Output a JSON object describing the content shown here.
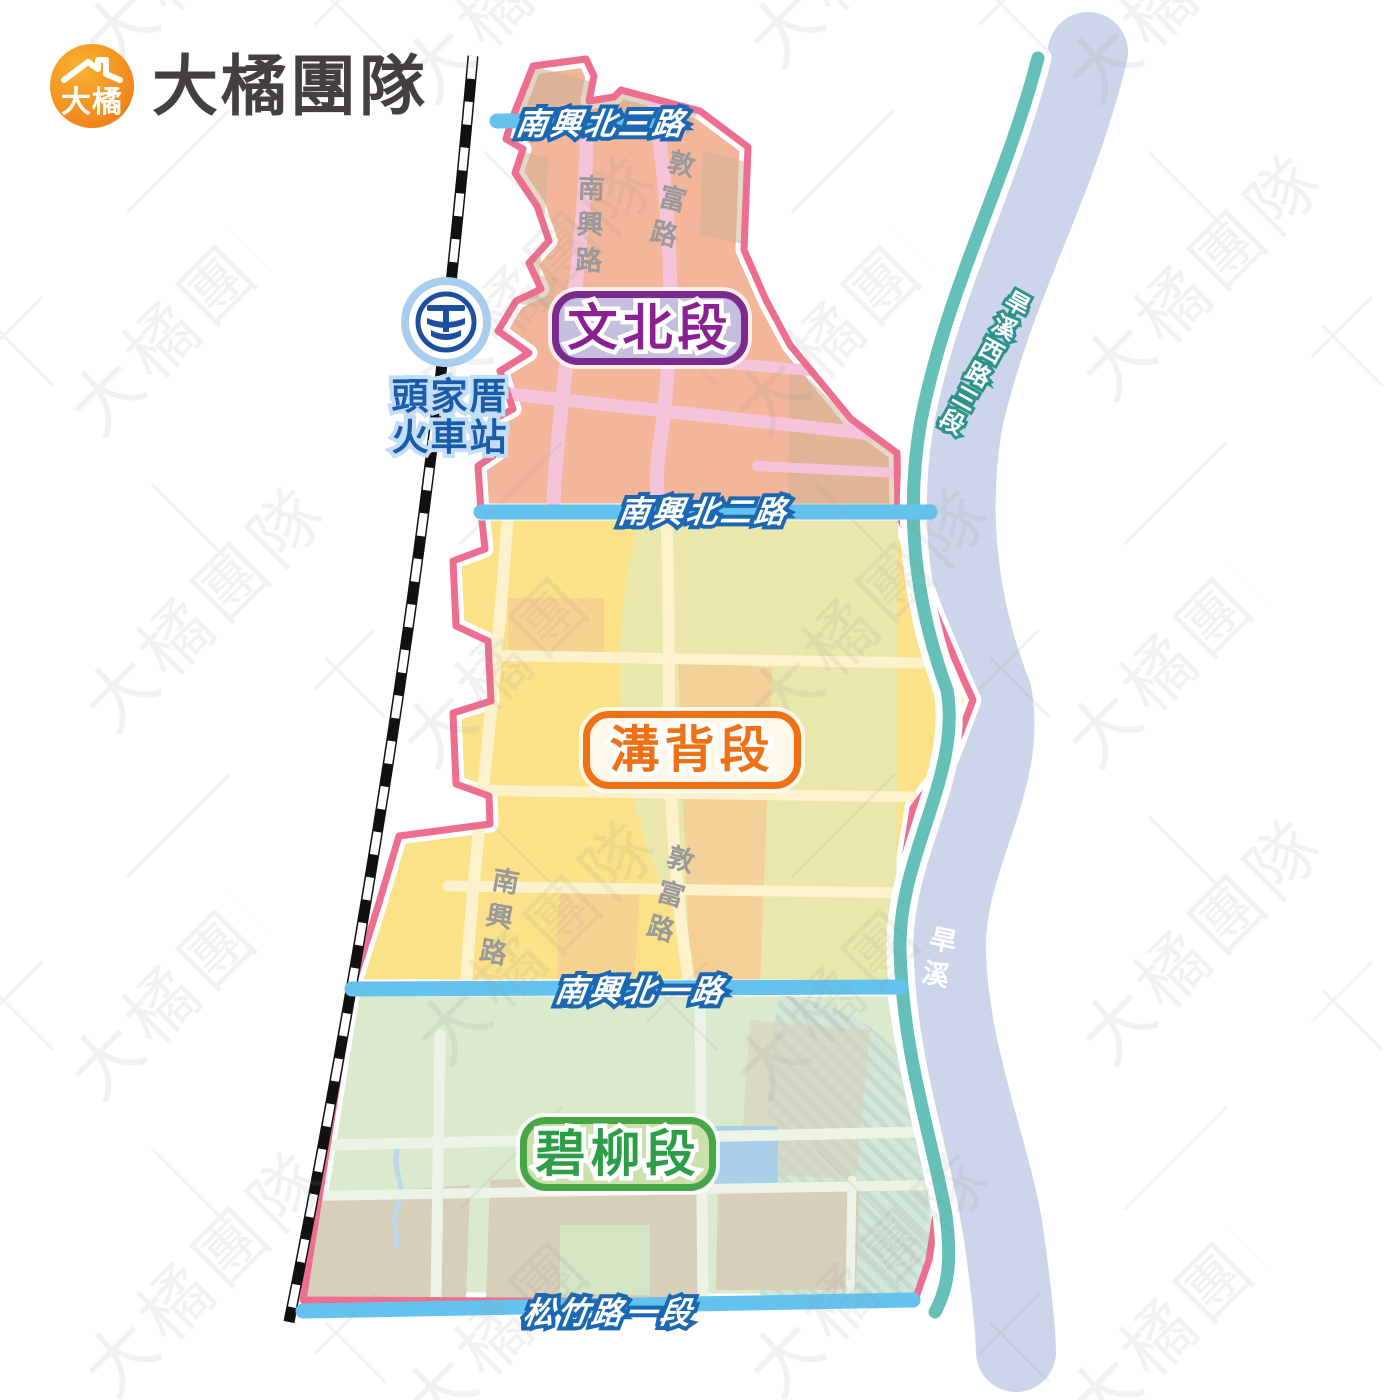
{
  "brand": {
    "badge_text": "大橘",
    "team_name": "大橘團隊"
  },
  "watermark": {
    "text": "大橘團隊"
  },
  "station": {
    "icon": "taiwan-railway-emblem",
    "name_line1": "頭家厝",
    "name_line2": "火車站"
  },
  "sections": [
    {
      "id": "wenbei",
      "label": "文北段",
      "box_fill": "#c6bedd",
      "box_border": "#7b2b8c",
      "text_color": "#8a2092",
      "area_fill": "#f4b69b"
    },
    {
      "id": "goubei",
      "label": "溝背段",
      "box_fill": "#fdf8ea",
      "box_border": "#ee7115",
      "text_color": "#ee7115",
      "area_fill": "#fbe289"
    },
    {
      "id": "biliu",
      "label": "碧柳段",
      "box_fill": "#cbe0ab",
      "box_border": "#47a648",
      "text_color": "#2d9e48",
      "area_fill": "#dbe9cd"
    }
  ],
  "roads": {
    "nanxing_north_3": "南興北三路",
    "nanxing_north_2": "南興北二路",
    "nanxing_north_1": "南興北一路",
    "songzhu_sec1": "松竹路一段",
    "hanxi_west_sec3": "旱溪西路三段"
  },
  "streets": {
    "nanxing": "南興路",
    "dunfu": "敦富路"
  },
  "river": {
    "name": "旱溪"
  },
  "colors": {
    "boundary_pink": "#ed6e8e",
    "road_blue": "#64c3ee",
    "road_label_blue": "#1c67b2",
    "teal_road": "#64c0b8",
    "river_fill": "#ccd5e9",
    "railway_black": "#111111",
    "station_blue": "#1d4f9e",
    "street_label_gray": "#999999",
    "logo_orange": "#f08314",
    "logo_text_dark": "#454040"
  }
}
